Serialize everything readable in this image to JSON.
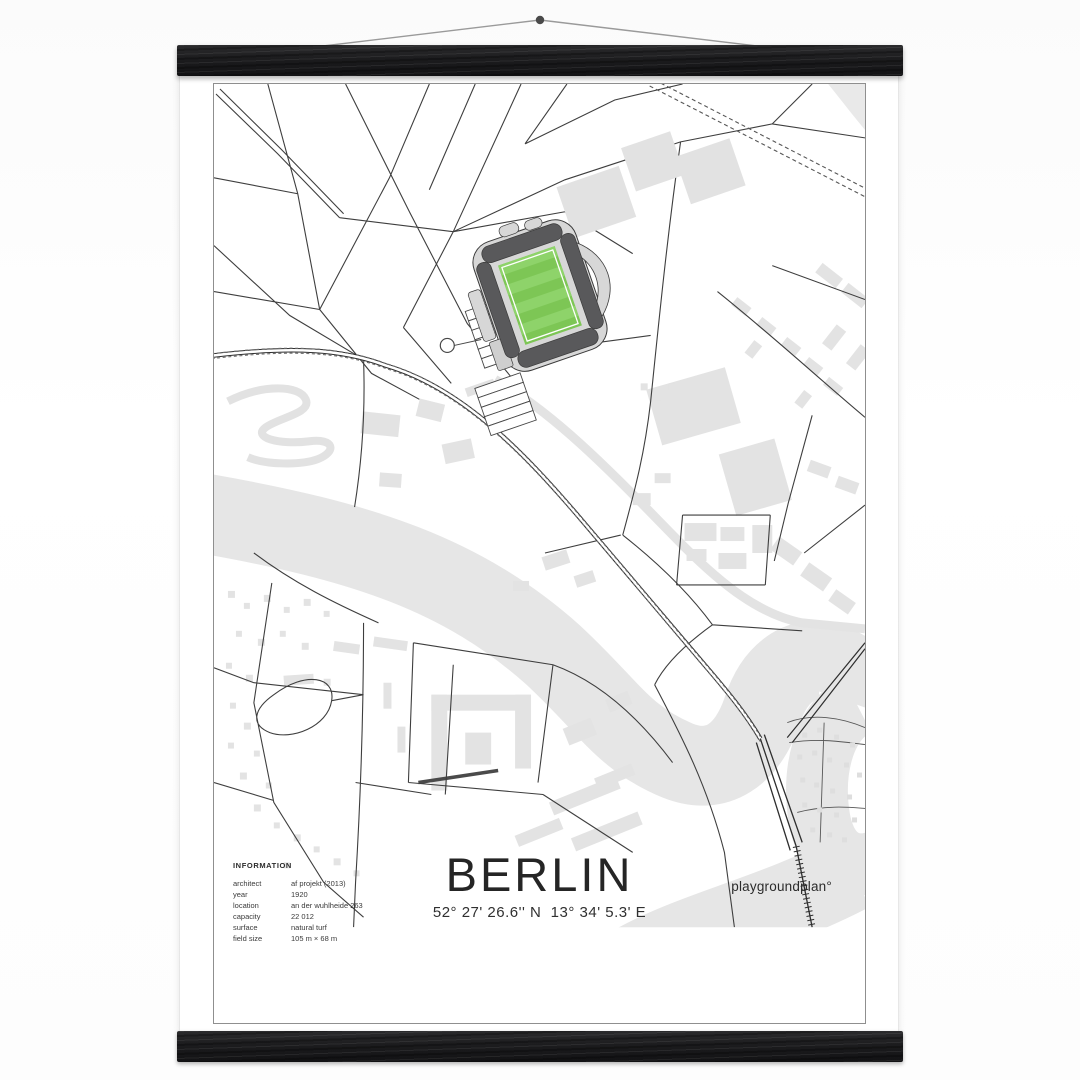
{
  "poster": {
    "title": "BERLIN",
    "coordinates": "52° 27' 26.6'' N  13° 34' 5.3' E",
    "brand": "playgroundplan°",
    "info": {
      "heading": "INFORMATION",
      "rows": [
        {
          "label": "architect",
          "value": "af projekt (2013)"
        },
        {
          "label": "year",
          "value": "1920"
        },
        {
          "label": "location",
          "value": "an der wuhlheide 263"
        },
        {
          "label": "capacity",
          "value": "22 012"
        },
        {
          "label": "surface",
          "value": "natural turf"
        },
        {
          "label": "field size",
          "value": "105 m × 68 m"
        }
      ]
    }
  },
  "colors": {
    "pitch_green": "#7dc655",
    "pitch_green_light": "#8ed36a",
    "stand_dark": "#59595b",
    "stand_light": "#d7d7d7",
    "building_gray": "#e3e3e3",
    "river_gray": "#e6e6e6",
    "road_dark": "#2e2e2e",
    "hanger_black": "#1d1d1f",
    "map_border": "#8f8f8f"
  }
}
